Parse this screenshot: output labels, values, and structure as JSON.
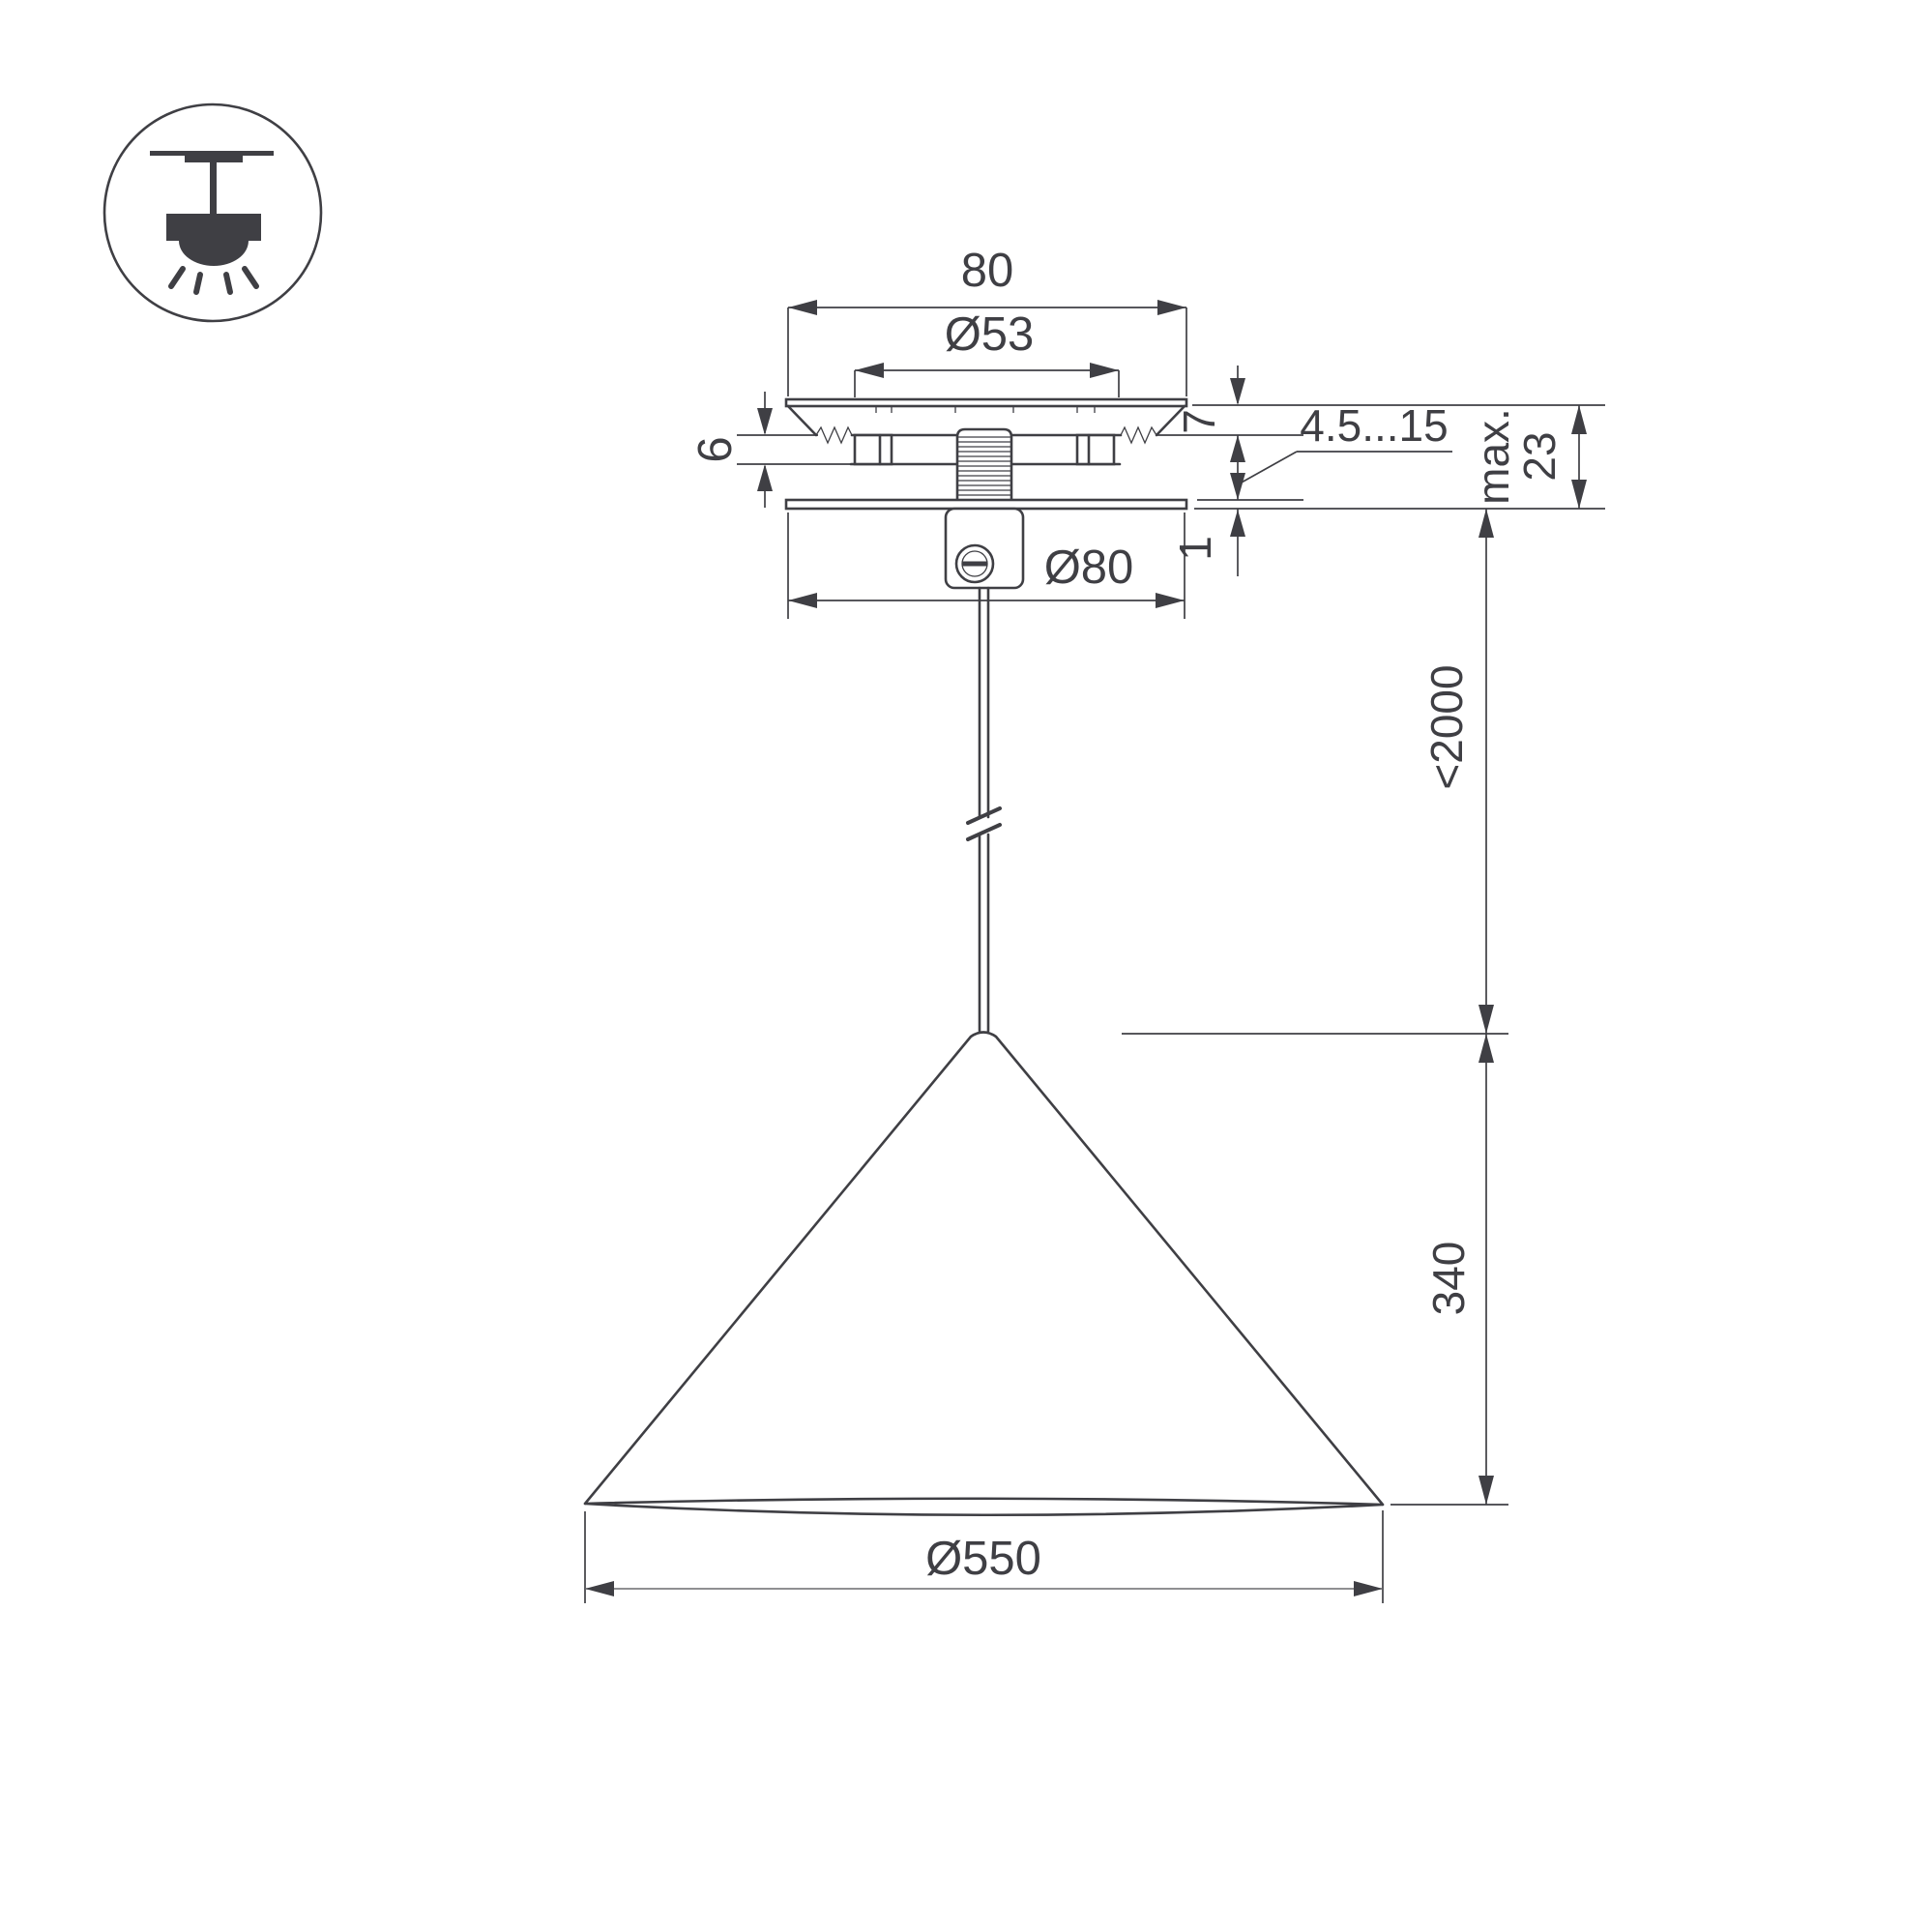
{
  "drawing": {
    "title": "pendant-lamp-dimension-drawing",
    "colors": {
      "line": "#3f3f44",
      "background": "#ffffff"
    },
    "icon": {
      "meaning": "surface-mounted-pendant-lamp"
    },
    "dimensions": {
      "canopy_width": "80",
      "hole_diameter": "Ø53",
      "flange_height": "7",
      "clip_height": "6",
      "ceiling_thickness_range": "4.5...15",
      "max_depth_prefix": "max.",
      "max_depth_value": "23",
      "plate_thickness": "1",
      "canopy_diameter": "Ø80",
      "cable_length": "<2000",
      "shade_height": "340",
      "shade_diameter": "Ø550"
    }
  }
}
